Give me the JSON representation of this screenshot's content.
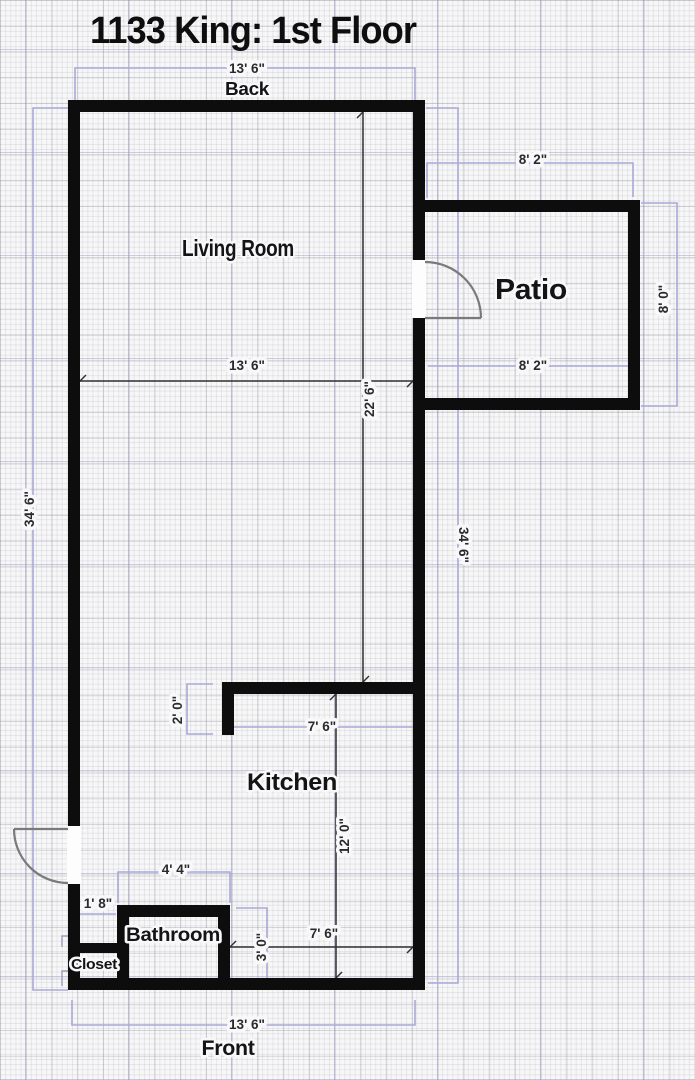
{
  "title": "1133 King: 1st Floor",
  "orientation": {
    "back": "Back",
    "front": "Front"
  },
  "rooms": {
    "living_room": "Living Room",
    "patio": "Patio",
    "kitchen": "Kitchen",
    "bathroom": "Bathroom",
    "closet": "Closet"
  },
  "dims": {
    "back_width": "13' 6\"",
    "front_width": "13' 6\"",
    "living_width": "13' 6\"",
    "living_height": "22' 6\"",
    "left_height": "34' 6\"",
    "right_height": "34' 6\"",
    "patio_top_width": "8' 2\"",
    "patio_bottom_width": "8' 2\"",
    "patio_height": "8' 0\"",
    "kitchen_entry": "2' 0\"",
    "kitchen_width": "7' 6\"",
    "kitchen_height": "12' 0\"",
    "bathroom_width": "4' 4\"",
    "closet_offset": "1' 8\"",
    "bathroom_height": "3' 0\"",
    "hall_width": "7' 6\""
  },
  "colors": {
    "paper": "#f7f7f8",
    "wall": "#0d0d0d",
    "dimension_line": "#a9a9d8",
    "dimension_text": "#2a2a2a",
    "door_arc": "#7a7a7a",
    "label_text": "#141414"
  }
}
